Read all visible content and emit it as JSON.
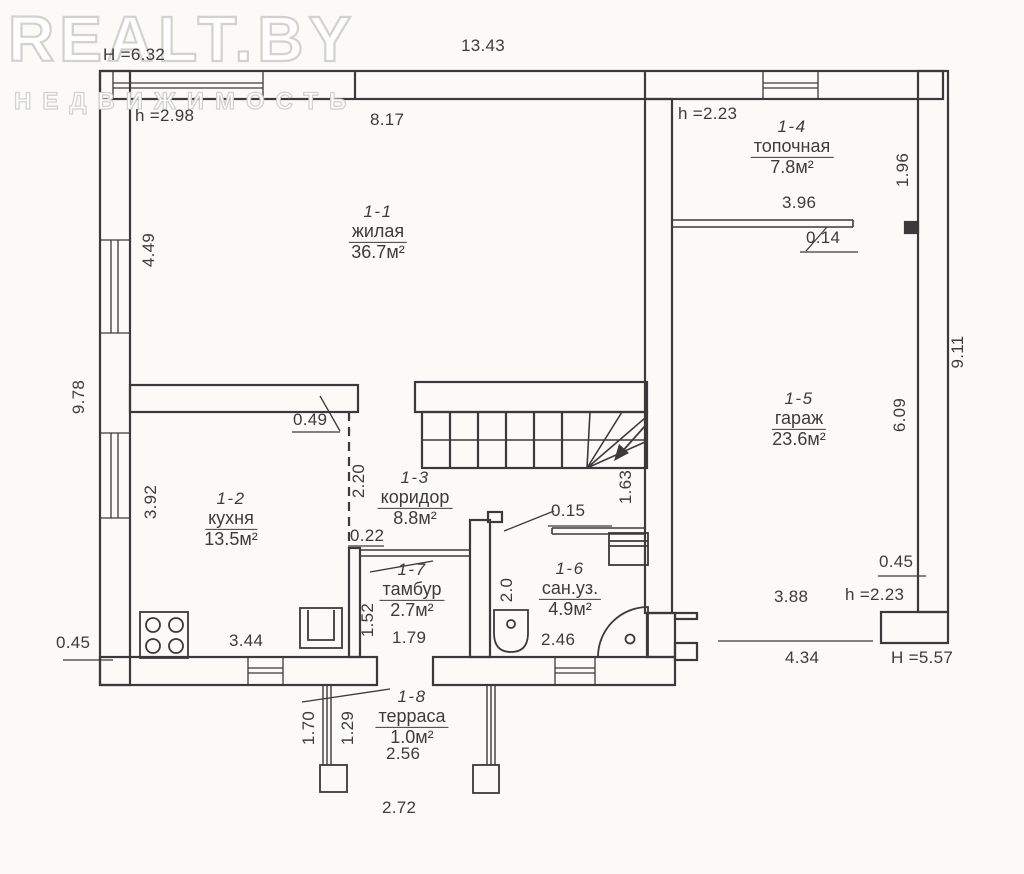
{
  "watermark": {
    "title": "REALT.BY",
    "subtitle": "НЕДВИЖИМОСТЬ"
  },
  "plan": {
    "rooms": [
      {
        "number": "1-1",
        "name": "жилая",
        "area": "36.7м²"
      },
      {
        "number": "1-2",
        "name": "кухня",
        "area": "13.5м²"
      },
      {
        "number": "1-3",
        "name": "коридор",
        "area": "8.8м²"
      },
      {
        "number": "1-4",
        "name": "топочная",
        "area": "7.8м²"
      },
      {
        "number": "1-5",
        "name": "гараж",
        "area": "23.6м²"
      },
      {
        "number": "1-6",
        "name": "сан.уз.",
        "area": "4.9м²"
      },
      {
        "number": "1-7",
        "name": "тамбур",
        "area": "2.7м²"
      },
      {
        "number": "1-8",
        "name": "терраса",
        "area": "1.0м²"
      }
    ],
    "dimensions": {
      "building_height": "H =6.32",
      "total_width": "13.43",
      "living_ceiling": "h =2.98",
      "living_width": "8.17",
      "boiler_ceiling": "h =2.23",
      "boiler_depth": "1.96",
      "boiler_width": "3.96",
      "boiler_door": "0.14",
      "right_side": "9.11",
      "garage_depth": "6.09",
      "left_upper": "4.49",
      "left_side": "9.78",
      "left_lower": "3.92",
      "wall_stub": "0.49",
      "opening": "2.20",
      "kitchen_wall": "0.22",
      "kitchen_width": "3.44",
      "left_offset": "0.45",
      "tambour_width": "1.79",
      "tambour_wall": "1.52",
      "sanuzel_depth": "2.0",
      "sanuzel_width": "2.46",
      "sanuzel_wall": "0.15",
      "stairs_width": "1.63",
      "garage_inner": "3.88",
      "garage_step": "0.45",
      "garage_ceiling": "h =2.23",
      "garage_door": "4.34",
      "garage_height": "H =5.57",
      "terrace_left": "1.70",
      "terrace_mid": "1.29",
      "terrace_width": "2.56",
      "terrace_outer": "2.72"
    },
    "colors": {
      "line": "#3a3a3a",
      "paper": "#fbfaf7",
      "watermark": "#cbcbc5"
    }
  }
}
